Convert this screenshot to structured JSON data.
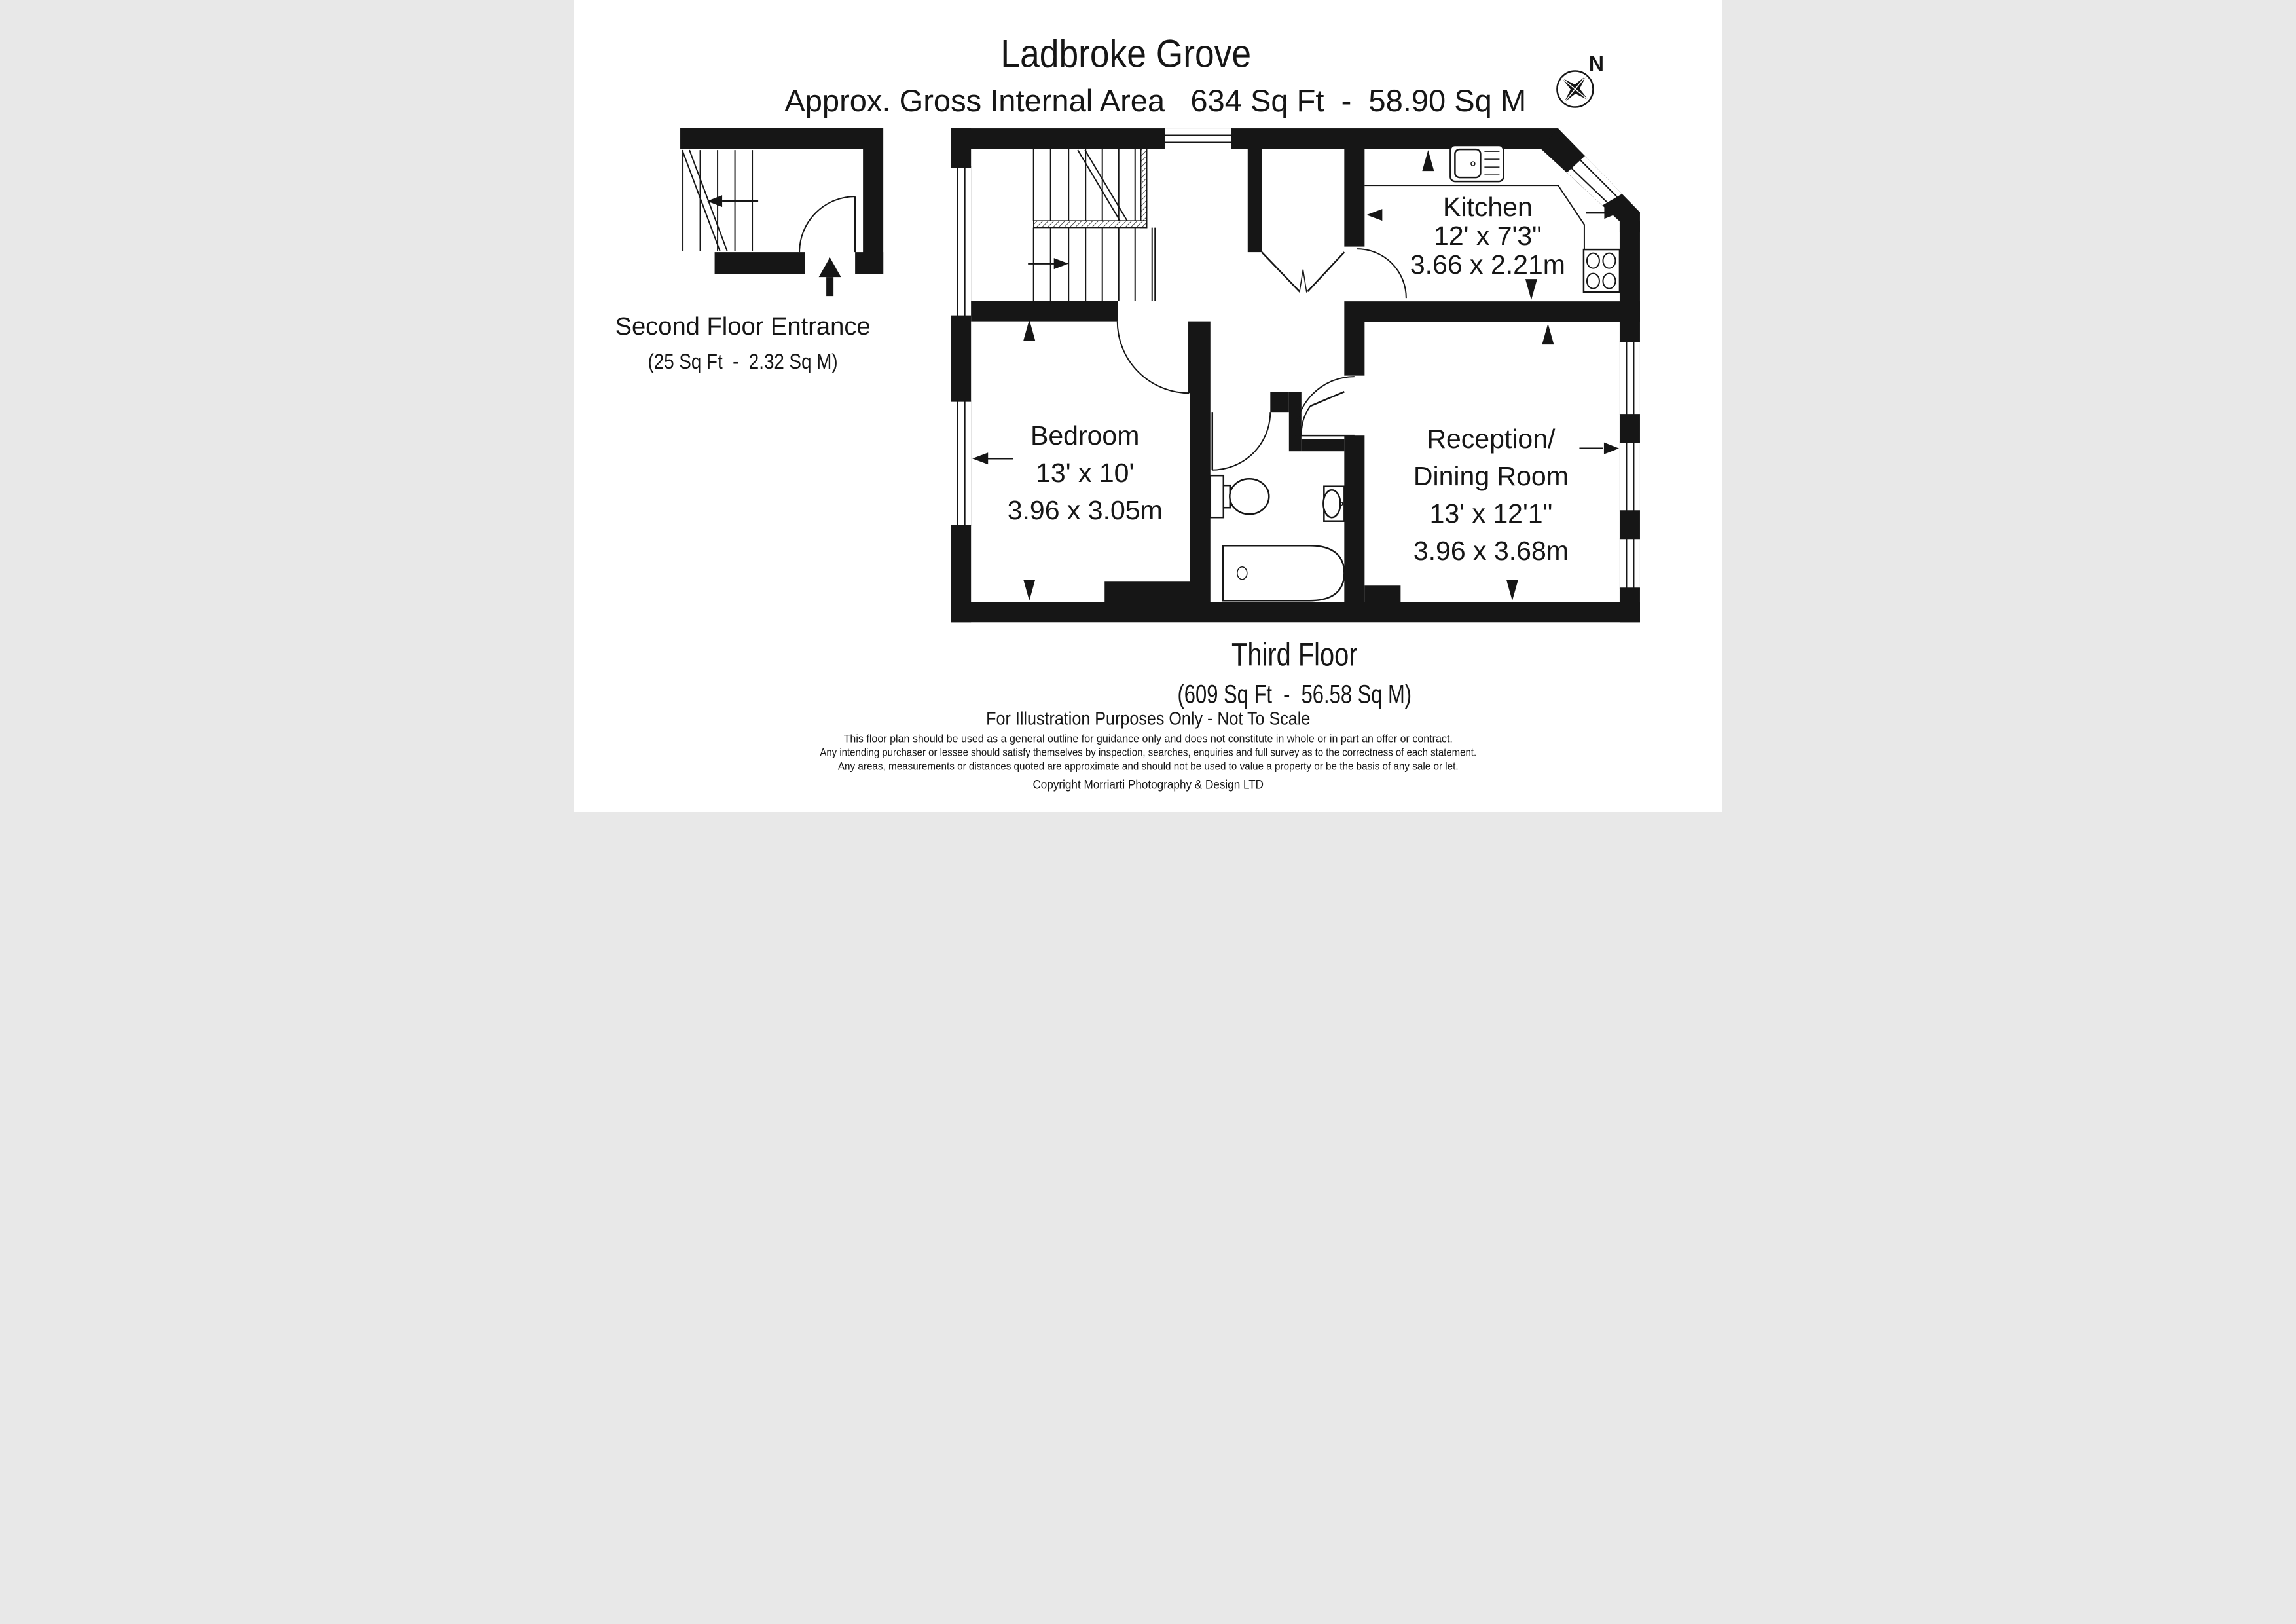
{
  "header": {
    "title": "Ladbroke Grove",
    "subtitle": "Approx. Gross Internal Area   634 Sq Ft  -  58.90 Sq M"
  },
  "compass": {
    "label": "N"
  },
  "entrance": {
    "name": "Second Floor Entrance",
    "area": "(25 Sq Ft  -  2.32 Sq M)"
  },
  "rooms": {
    "kitchen": {
      "name": "Kitchen",
      "imperial": "12' x 7'3\"",
      "metric": "3.66 x 2.21m"
    },
    "bedroom": {
      "name": "Bedroom",
      "imperial": "13' x 10'",
      "metric": "3.96 x 3.05m"
    },
    "reception": {
      "line1": "Reception/",
      "line2": "Dining Room",
      "imperial": "13' x 12'1\"",
      "metric": "3.96 x 3.68m"
    }
  },
  "floor": {
    "name": "Third Floor",
    "area": "(609 Sq Ft  -  56.58 Sq M)"
  },
  "footer": {
    "note": "For Illustration Purposes Only - Not To Scale",
    "disclaimer1": "This floor plan should be used as a general outline for guidance only and does not constitute in whole or in part an offer or contract.",
    "disclaimer2": "Any intending purchaser or lessee should satisfy themselves by inspection, searches, enquiries and full survey as to the correctness of each statement.",
    "disclaimer3": "Any areas, measurements or distances quoted are approximate and should not be used to value a property or be the basis of any sale or let.",
    "copyright": "Copyright Morriarti Photography & Design LTD"
  },
  "icons": {
    "compass-icon": "four point compass star",
    "sink-icon": "kitchen sink with drainer",
    "hob-icon": "4 ring hob",
    "toilet-icon": "toilet",
    "washbasin-icon": "wash basin",
    "bathtub-icon": "bath tub",
    "entrance-arrow-icon": "entry direction arrow",
    "stair-arrow-icon": "stair direction arrow"
  },
  "colors": {
    "ink": "#161616",
    "paper": "#ffffff"
  }
}
